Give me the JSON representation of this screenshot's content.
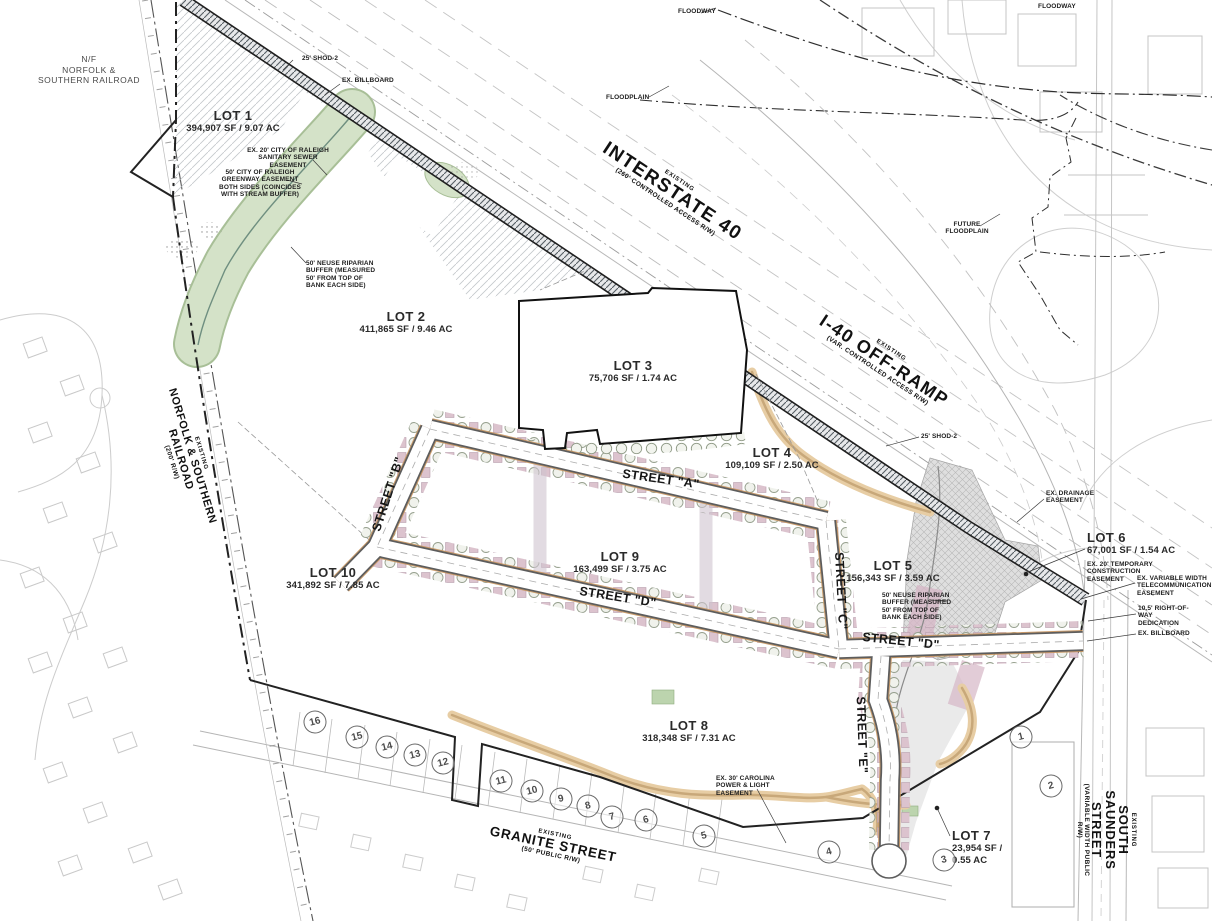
{
  "lots": [
    {
      "name": "LOT 1",
      "area": "394,907 SF / 9.07 AC"
    },
    {
      "name": "LOT 2",
      "area": "411,865 SF / 9.46 AC"
    },
    {
      "name": "LOT 3",
      "area": "75,706 SF / 1.74 AC"
    },
    {
      "name": "LOT 4",
      "area": "109,109 SF / 2.50 AC"
    },
    {
      "name": "LOT 5",
      "area": "156,343 SF / 3.59 AC"
    },
    {
      "name": "LOT 6",
      "area": "67,001 SF / 1.54 AC"
    },
    {
      "name": "LOT 7",
      "area": "23,954 SF / 0.55 AC"
    },
    {
      "name": "LOT 8",
      "area": "318,348 SF / 7.31 AC"
    },
    {
      "name": "LOT 9",
      "area": "163,499 SF / 3.75 AC"
    },
    {
      "name": "LOT 10",
      "area": "341,892 SF / 7.85 AC"
    }
  ],
  "streets": {
    "street_a": "STREET \"A\"",
    "street_b": "STREET \"B\"",
    "street_c": "STREET \"C\"",
    "street_d_west": "STREET \"D\"",
    "street_d_east": "STREET \"D\"",
    "street_e": "STREET \"E\""
  },
  "roads": {
    "interstate": {
      "prefix": "EXISTING",
      "name": "INTERSTATE 40",
      "suffix": "(260' CONTROLLED ACCESS R/W)"
    },
    "off_ramp": {
      "prefix": "EXISTING",
      "name": "I-40 OFF-RAMP",
      "suffix": "(VAR. CONTROLLED ACCESS R/W)"
    },
    "railroad": {
      "prefix": "EXISTING",
      "name": "NORFOLK & SOUTHERN RAILROAD",
      "suffix": "(200' R/W)"
    },
    "granite": {
      "prefix": "EXISTING",
      "name": "GRANITE STREET",
      "suffix": "(50' PUBLIC R/W)"
    },
    "saunders": {
      "prefix": "EXISTING",
      "name": "SOUTH SAUNDERS STREET",
      "suffix": "(VARIABLE WIDTH PUBLIC R/W)"
    },
    "nf_owner_line1": "N/F",
    "nf_owner_line2": "NORFOLK &",
    "nf_owner_line3": "SOUTHERN RAILROAD"
  },
  "annotations": {
    "shod_top": "25' SHOD-2",
    "shod_mid": "25' SHOD-2",
    "billboard_top": "EX. BILLBOARD",
    "billboard_right": "EX. BILLBOARD",
    "sewer": "EX. 20' CITY OF RALEIGH SANITARY SEWER EASEMENT",
    "greenway": "50' CITY OF RALEIGH GREENWAY EASEMENT BOTH SIDES (COINCIDES WITH STREAM BUFFER)",
    "neuse_left": "50' NEUSE RIPARIAN BUFFER (MEASURED 50' FROM TOP OF BANK EACH SIDE)",
    "neuse_right": "50' NEUSE RIPARIAN BUFFER (MEASURED 50' FROM TOP OF BANK EACH SIDE)",
    "drainage": "EX. DRAINAGE EASEMENT",
    "temp_construction": "EX. 20' TEMPORARY CONSTRUCTION EASEMENT",
    "telecom": "EX. VARIABLE WIDTH TELECOMMUNICATION EASEMENT",
    "row_dedication": "10.5' RIGHT-OF-WAY DEDICATION",
    "cpl": "EX. 30' CAROLINA POWER & LIGHT EASEMENT",
    "floodway": "FLOODWAY",
    "floodplain": "FLOODPLAIN",
    "future_floodplain": "FUTURE FLOODPLAIN"
  },
  "parcels": [
    "1",
    "2",
    "3",
    "4",
    "5",
    "6",
    "7",
    "8",
    "9",
    "10",
    "11",
    "12",
    "13",
    "14",
    "15",
    "16"
  ],
  "colors": {
    "greenway_fill": "#d4e2c8",
    "greenway_edge": "#a8bf97",
    "trail_tan": "#e7cda4",
    "building_pink": "#dcc3ce",
    "drainage_gray": "#dcdcdc",
    "boundary_black": "#222222"
  }
}
